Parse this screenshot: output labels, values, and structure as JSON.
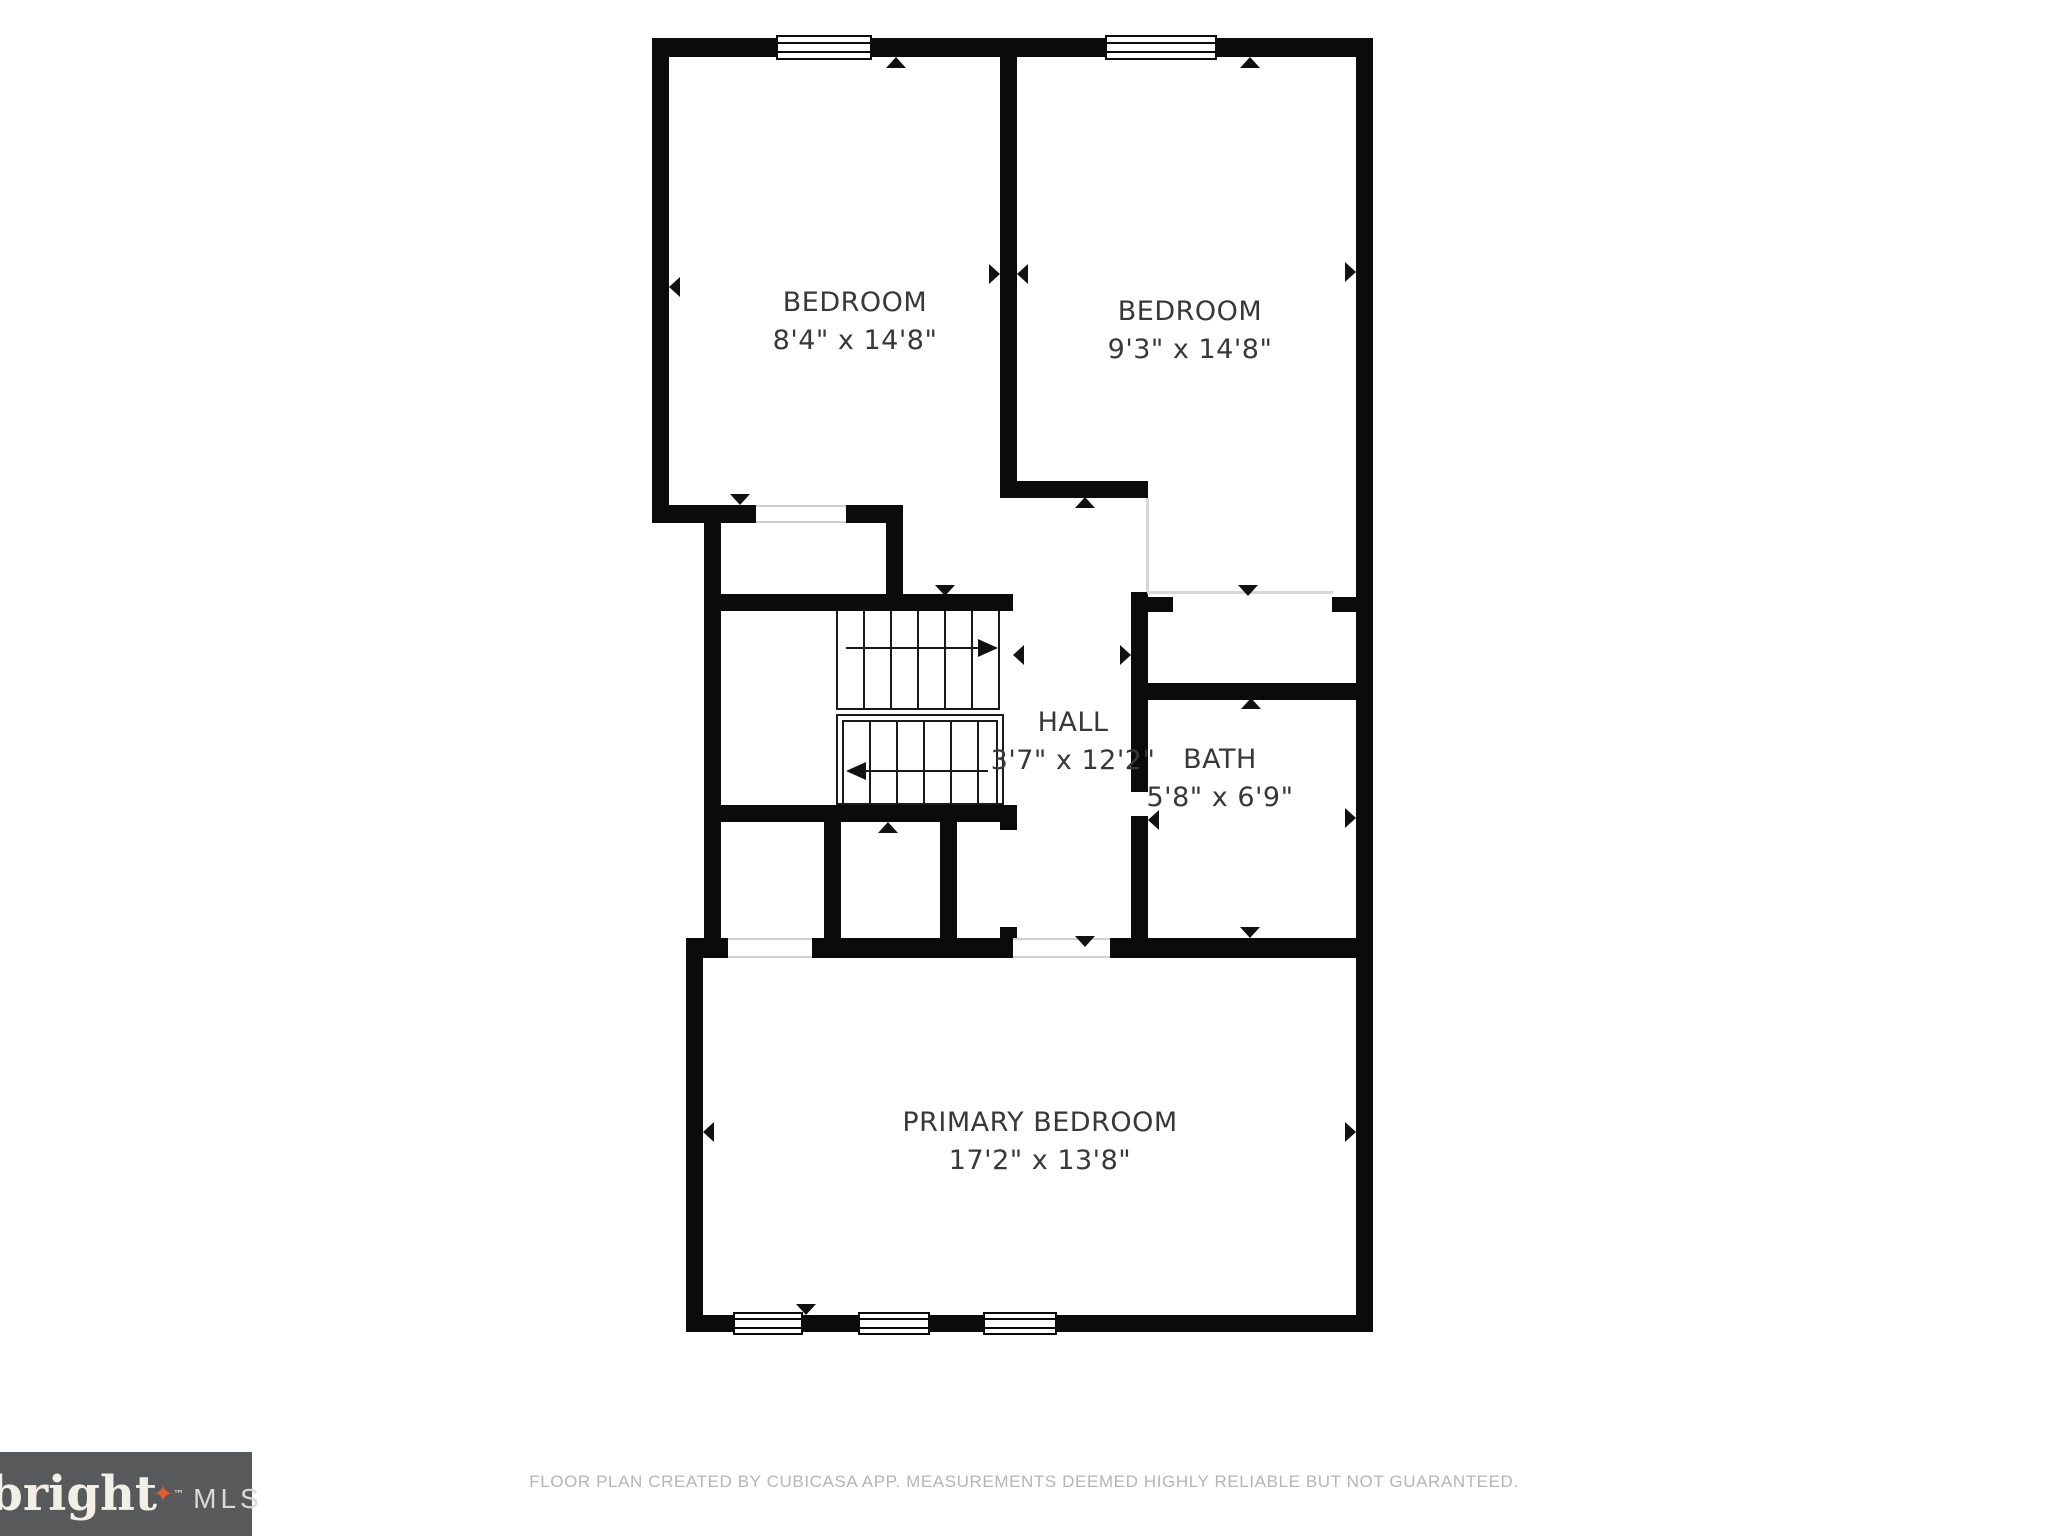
{
  "rooms": {
    "bedroom1": {
      "name": "BEDROOM",
      "dims": "8'4\" x 14'8\""
    },
    "bedroom2": {
      "name": "BEDROOM",
      "dims": "9'3\" x 14'8\""
    },
    "hall": {
      "name": "HALL",
      "dims": "3'7\" x 12'2\""
    },
    "bath": {
      "name": "BATH",
      "dims": "5'8\" x 6'9\""
    },
    "primary": {
      "name": "PRIMARY BEDROOM",
      "dims": "17'2\" x 13'8\""
    }
  },
  "logo": {
    "brand": "bright",
    "star": "✦",
    "trademark": "™",
    "suffix": "MLS"
  },
  "footer": {
    "disclaimer": "FLOOR PLAN CREATED BY CUBICASA APP. MEASUREMENTS DEEMED HIGHLY RELIABLE BUT NOT GUARANTEED."
  },
  "colors": {
    "wall": "#0b0b0b",
    "label_text": "#383838",
    "logo_bg": "#58595b",
    "logo_star": "#e55b2d",
    "disclaimer_text": "#b5b5b5"
  }
}
